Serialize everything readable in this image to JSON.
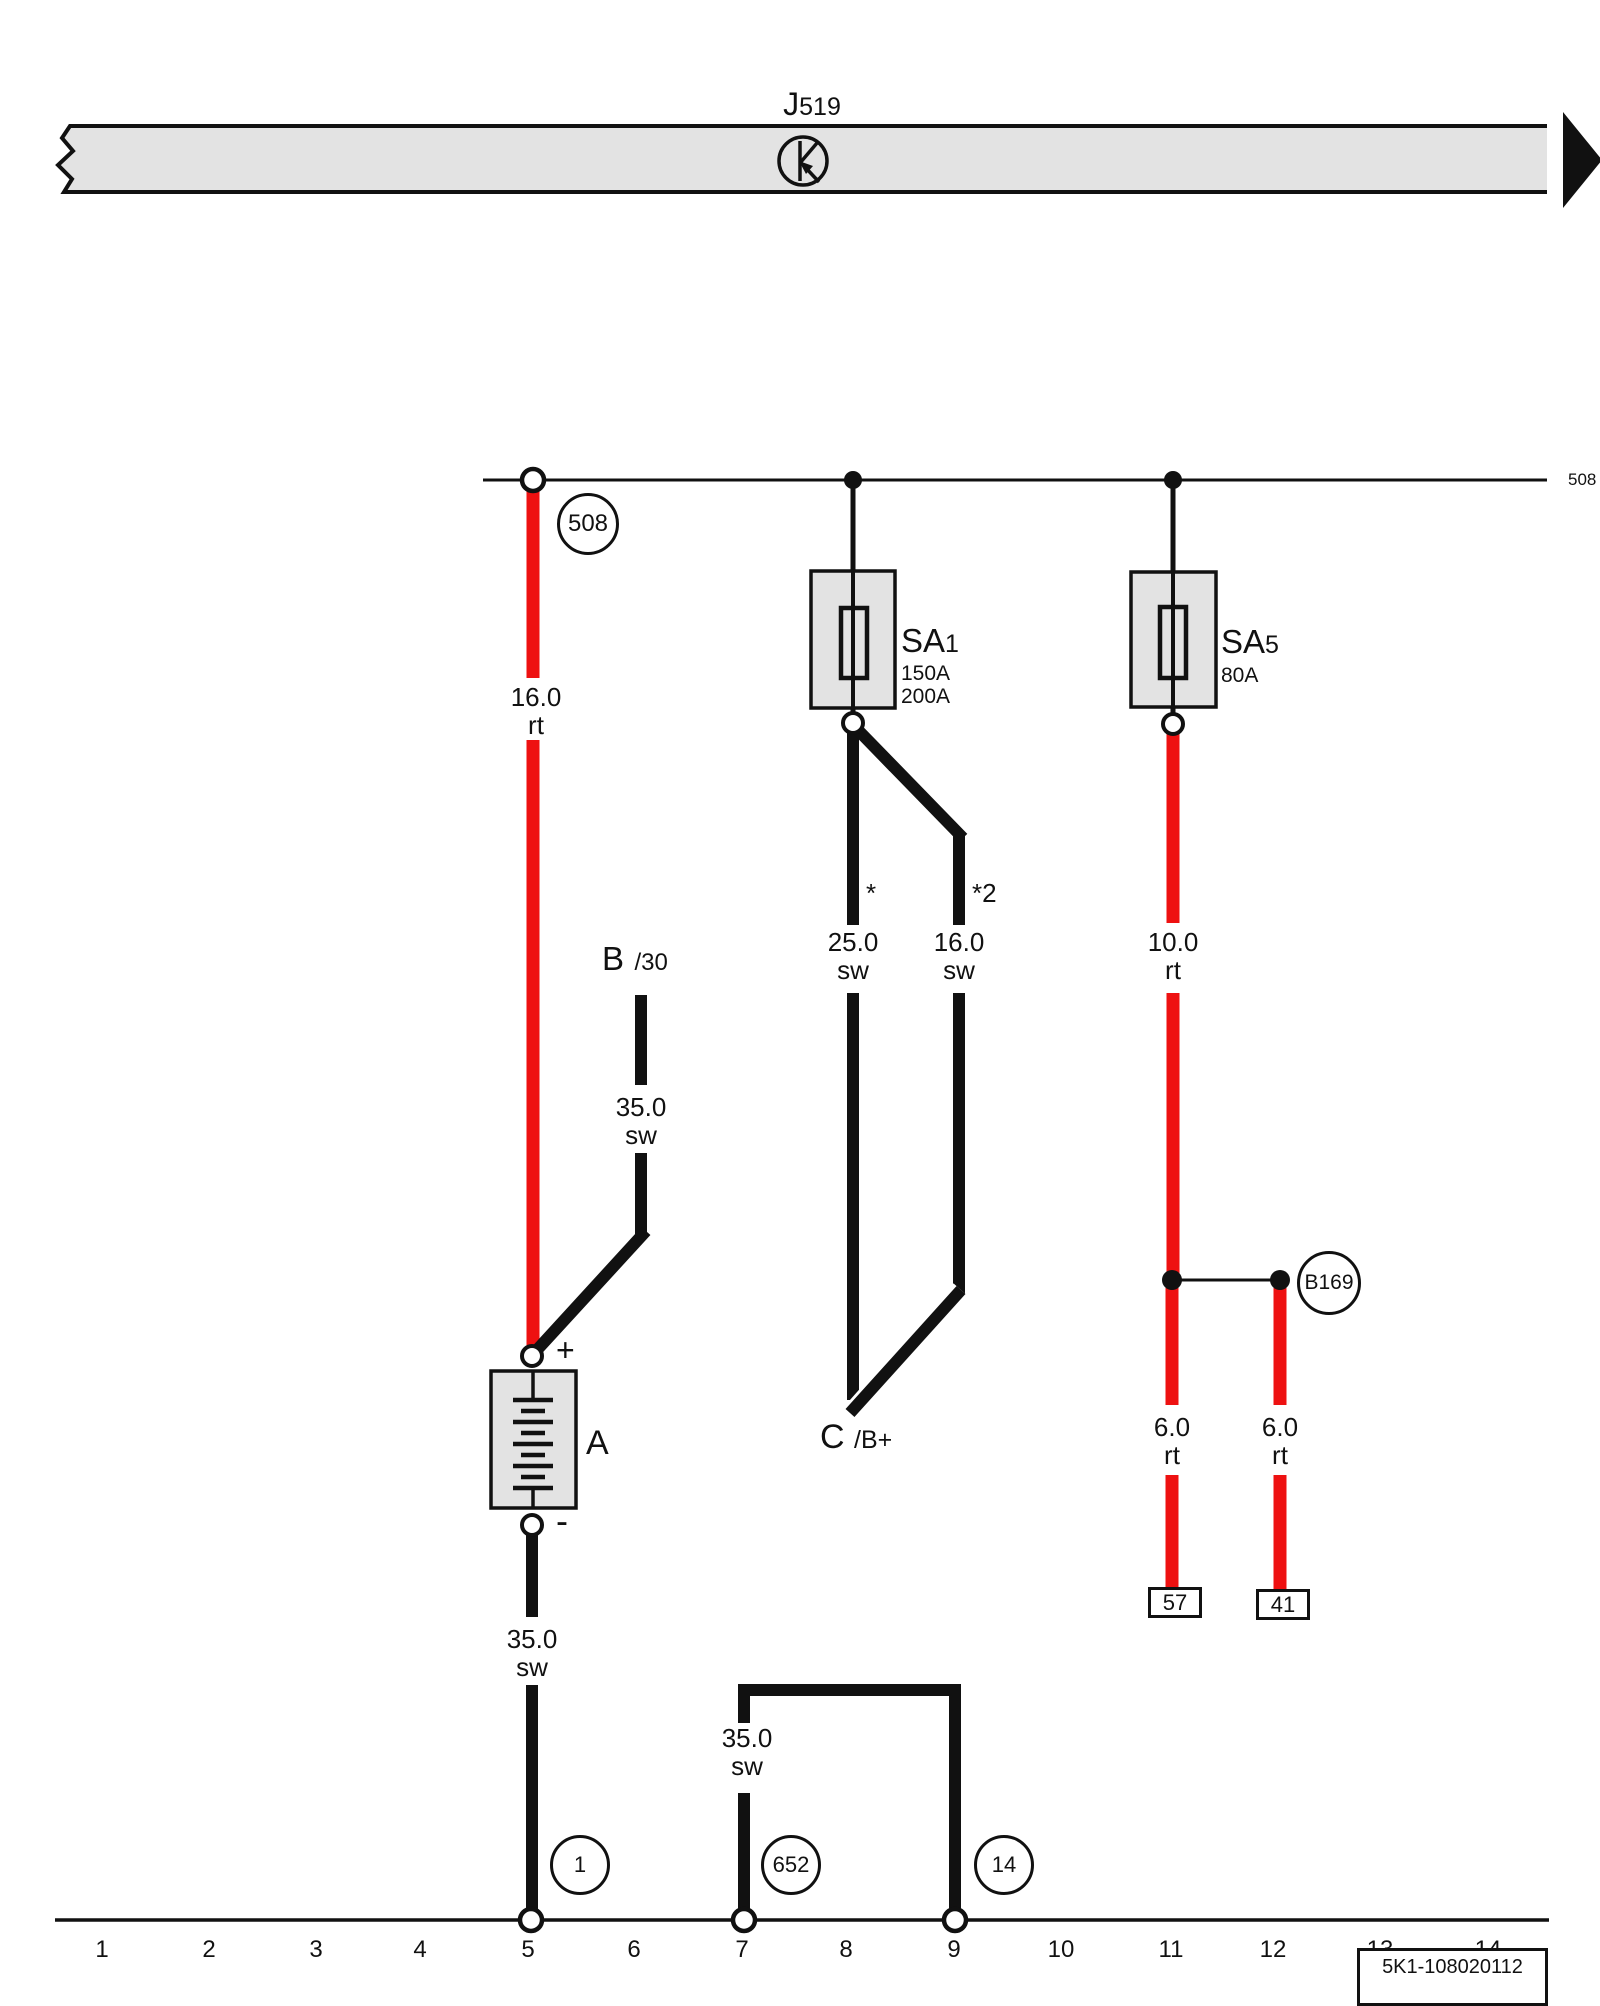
{
  "module": {
    "name": "J",
    "sub": "519"
  },
  "track": {
    "number": "508"
  },
  "fuse_sa1": {
    "prefix": "SA",
    "sub": "1",
    "rating1": "150A",
    "rating2": "200A"
  },
  "fuse_sa5": {
    "prefix": "SA",
    "sub": "5",
    "rating1": "80A"
  },
  "battery": {
    "label": "A",
    "plus": "+",
    "minus": "-"
  },
  "terminal_b30": {
    "main": "B",
    "sub": "/30"
  },
  "terminal_bplus": {
    "main": "C",
    "sub": "/B+"
  },
  "junctions": {
    "b169": "B169",
    "ground_1": "1",
    "ground_652": "652",
    "ground_14": "14"
  },
  "terminal_boxes": {
    "t57": "57",
    "t41": "41"
  },
  "wires": {
    "w_16rt": {
      "gauge": "16.0",
      "color": "rt"
    },
    "w_35sw_b30": {
      "gauge": "35.0",
      "color": "sw"
    },
    "w_25sw": {
      "gauge": "25.0",
      "color": "sw",
      "note": "*"
    },
    "w_16sw": {
      "gauge": "16.0",
      "color": "sw",
      "note": "*2"
    },
    "w_10rt": {
      "gauge": "10.0",
      "color": "rt"
    },
    "w_6rt_a": {
      "gauge": "6.0",
      "color": "rt"
    },
    "w_6rt_b": {
      "gauge": "6.0",
      "color": "rt"
    },
    "w_35sw_gnd": {
      "gauge": "35.0",
      "color": "sw"
    },
    "w_35sw_loop": {
      "gauge": "35.0",
      "color": "sw"
    }
  },
  "grid": {
    "numbers": [
      "1",
      "2",
      "3",
      "4",
      "5",
      "6",
      "7",
      "8",
      "9",
      "10",
      "11",
      "12",
      "13",
      "14"
    ]
  },
  "doc_id": "5K1-108020112",
  "colors": {
    "wire_red": "#ee1111",
    "component_fill": "#e3e3e3",
    "line": "#111111"
  }
}
